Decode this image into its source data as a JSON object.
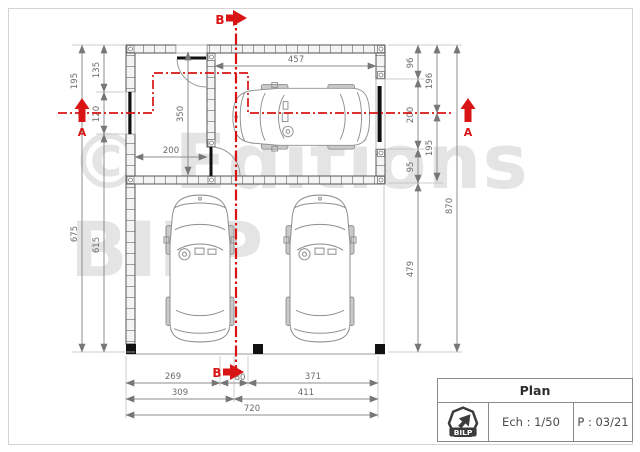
{
  "watermark": {
    "line1": "© Editions",
    "line2": "BILP"
  },
  "sections": {
    "a_label": "A",
    "b_label": "B"
  },
  "dims": {
    "left_195": "195",
    "left_135": "135",
    "left_120": "120",
    "left_675": "675",
    "left_615": "615",
    "top_457": "457",
    "interior_350": "350",
    "interior_200": "200",
    "right_96": "96",
    "right_196": "196",
    "right_200": "200",
    "right_195": "195",
    "right_95": "95",
    "right_479": "479",
    "right_870": "870",
    "bottom_269": "269",
    "bottom_80": "80",
    "bottom_371": "371",
    "bottom_309": "309",
    "bottom_411": "411",
    "bottom_720": "720"
  },
  "title_block": {
    "title": "Plan",
    "scale": "Ech : 1/50",
    "page": "P : 03/21",
    "logo_text": "BILP"
  },
  "colors": {
    "section_red": "#d81414",
    "dim_gray": "#6a6a6a",
    "line_gray": "#8c8c8c",
    "wall_gray": "#555555",
    "watermark_gray": "#e4e4e4"
  }
}
